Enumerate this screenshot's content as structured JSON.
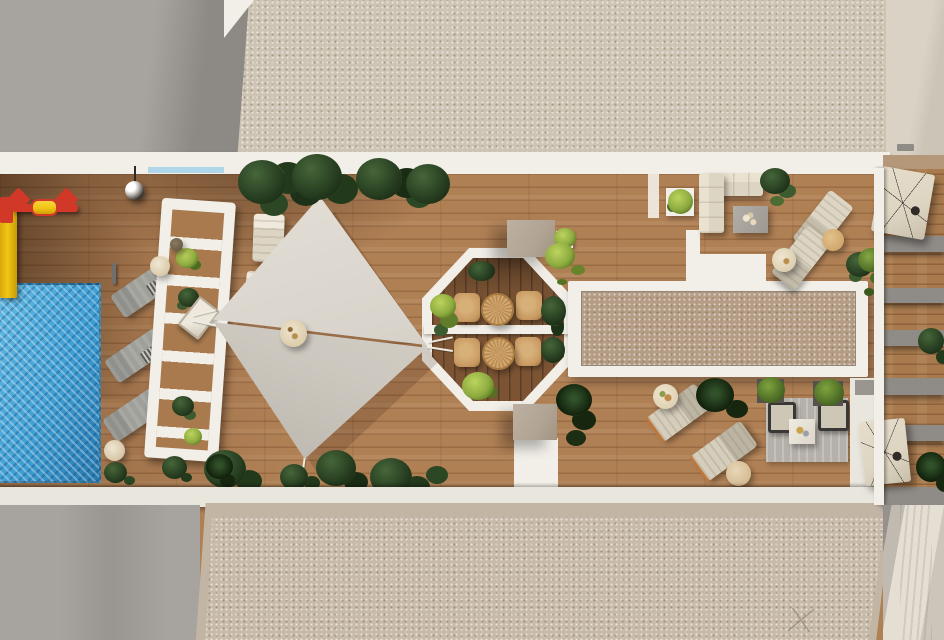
{
  "scene": {
    "kind": "aerial-3d-render",
    "subject": "rooftop-terrace-plan"
  },
  "colors": {
    "gray_roof": "#a7a39f",
    "gray_roof_dark": "#8d8985",
    "gravel_top": "#cec4b4",
    "gravel_bottom": "#c7baa9",
    "gravel_border": "#c2b5a4",
    "gravel_inset": "#b59c85",
    "white": "#f2efe8",
    "white_dim": "#e9e6de",
    "wood": "#b08055",
    "wood_dark": "#7c5434",
    "wood_strip": "#a87a4e",
    "pool": "#3f9fd4",
    "pool_deep": "#2577ad",
    "sail": "#d9d4cb",
    "sail2": "#cdc8bf",
    "plant_dark": "#1d3118",
    "plant_mid": "#3c5c30",
    "plant_bright": "#8cab3f",
    "taupe": "#b2a494",
    "gray_lounger": "#a0a09b",
    "beige_lounger": "#cdc5b3",
    "sofa": "#ddd5c3",
    "rug": "#b5b1aa",
    "rattan": "#c89a62",
    "red": "#d23828",
    "yellow": "#f2c414",
    "umbrella": "#ddd4c2",
    "wall_cream": "#d9d2c5",
    "band_gray": "#8f8b86",
    "water_edge": "#9fd1e8"
  }
}
